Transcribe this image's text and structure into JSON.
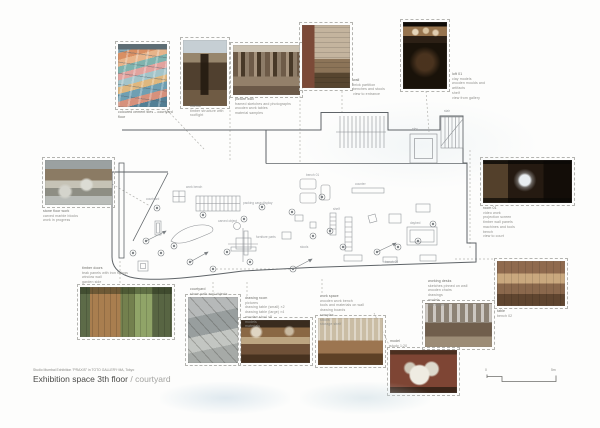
{
  "page": {
    "kind": "architectural presentation board",
    "colors": {
      "paper": "#fdfdfc",
      "wall_line": "#5f6468",
      "furniture_line": "#8f9296",
      "dashed_connector": "#b4b4b0",
      "caption_text": "#8f8f8b",
      "title_text": "#4a4a48",
      "title_muted": "#a3a3a0"
    }
  },
  "footer": {
    "subtitle": "Studio Mumbai Exhibition \"PRAXIS\" in TOTO GALLERY·MA, Tokyo",
    "title_main": "Exhibition space 3th floor",
    "title_separator": "/",
    "title_secondary": "courtyard"
  },
  "scale_bar": {
    "label_left": "0",
    "label_right": "5m"
  },
  "photos": {
    "tiled_floor": {
      "caption": [
        "coloured cement tiles – courtyard floor"
      ]
    },
    "timber_interior": {
      "caption": [
        "interior",
        "timber structure with rooflight"
      ]
    },
    "picture_wall": {
      "caption": [
        "picture wall",
        "framed sketches and photographs",
        "wooden work tables",
        "material samples"
      ]
    },
    "brick_room": {
      "caption": [
        "wall",
        "brick partition",
        "benches and stools",
        "view to entrance"
      ]
    },
    "artifact_loft": {
      "caption": [
        "loft 01",
        "clay models",
        "wooden moulds and artifacts",
        "shelf",
        "view from gallery"
      ]
    },
    "projection_room": {
      "caption": [
        "room 01",
        "video work",
        "projection screen",
        "timber wall panels",
        "machines and tools",
        "bench",
        "view to court"
      ]
    },
    "wooden_table": {
      "caption": [
        "table",
        "bench 02"
      ]
    },
    "studio_desks": {
      "caption": [
        "working desks",
        "sketches pinned on wall",
        "wooden chairs",
        "drawings",
        "models",
        "tool boxes"
      ]
    },
    "model_note": {
      "caption": [
        "model",
        "study 1:20"
      ]
    },
    "stone_floor": {
      "caption": [
        "stone floor work",
        "carved marble blocks",
        "work in progress"
      ]
    },
    "timber_doors": {
      "caption": [
        "timber doors",
        "teak panels with iron fittings",
        "window wall",
        "garden side"
      ]
    },
    "courtyard": {
      "caption": [
        "courtyard",
        "stone path and objects"
      ]
    },
    "drawing_room": {
      "caption": [
        "drawing room",
        "pictures",
        "drawing table (small) ×2",
        "drawing table (large) ×4",
        "wooden stool ×8",
        "models",
        "materials"
      ]
    },
    "work_space": {
      "caption": [
        "work space",
        "wooden work bench",
        "tools and materials on wall",
        "drawing boards",
        "samples",
        "stools",
        "storage shelf"
      ]
    }
  },
  "plan": {
    "labels": {
      "packing": "packing case display",
      "workbench": "work bench",
      "carved": "carved object",
      "parts": "furniture parts",
      "bench01": "bench 01",
      "counter": "counter",
      "daybed": "daybed",
      "shelf": "shelf",
      "courtyard": "courtyard",
      "stair": "stair",
      "elev": "elev.",
      "bench03": "bench 03",
      "stools": "stools"
    }
  }
}
